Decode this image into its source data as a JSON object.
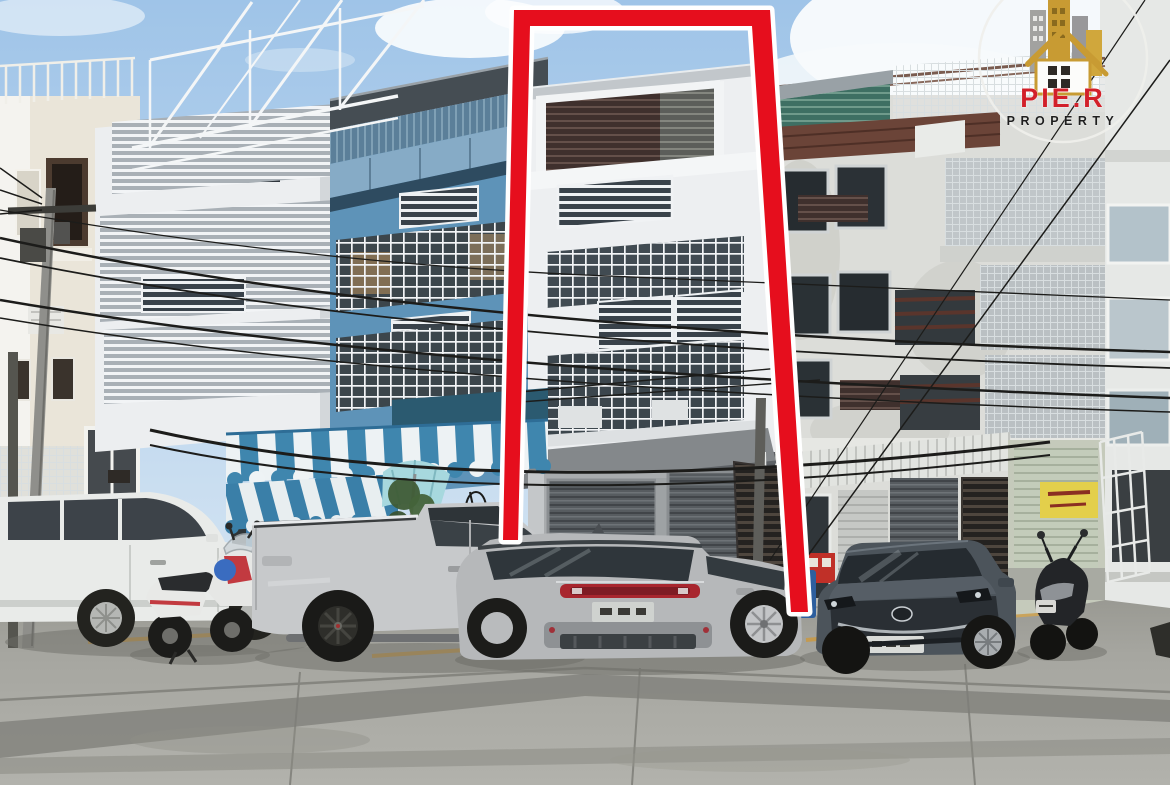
{
  "page": {
    "type": "real-estate-listing-photo",
    "subject": "Street view of shophouse row with one tall unit outlined in red"
  },
  "logo": {
    "brand": "PIE.R",
    "tagline": "PROPERTY",
    "brand_color": "#d2202a",
    "tagline_color": "#1e1e1e",
    "ring_color": "#efefec",
    "emblem_gold": "#c89b33",
    "emblem_gray": "#a0a0a0"
  },
  "highlight_frame": {
    "shape": "tall-rectangle-outline-open-bottom",
    "fill": "#e60e1d",
    "outline": "#ffffff",
    "meaning": "marks the subject building"
  },
  "palette": {
    "sky_top": "#9fc4e8",
    "sky_bottom": "#d7e6f3",
    "cloud": "#fbfdfe",
    "road": "#a6a6a2",
    "road_patch": "#7d7d78",
    "parking_line": "#c49a4f",
    "awning_blue": "#3f86ae",
    "awning_white": "#edf2f4",
    "subject_facade": "#edeff1",
    "subject_top_louver": "#3f302d",
    "blue_building": "#5e93b8",
    "white_louver_building": "#eceef0",
    "cream_building": "#eae5d9",
    "right_building": "#dcddd9",
    "teal_louver": "#3e6f63",
    "rust_rail": "#6b4438",
    "shutter_gray": "#575c60",
    "sign_yellow": "#e3cf4b"
  },
  "scene": {
    "buildings": [
      {
        "name": "left-cream-walkup"
      },
      {
        "name": "white-louver-shophouse"
      },
      {
        "name": "blue-glass-shophouse"
      },
      {
        "name": "subject-shophouse-highlighted"
      },
      {
        "name": "aged-white-shophouse"
      },
      {
        "name": "far-right-building"
      }
    ],
    "vehicles": [
      {
        "name": "white-sedan"
      },
      {
        "name": "red-white-scooter"
      },
      {
        "name": "silver-pickup-truck"
      },
      {
        "name": "silver-suv"
      },
      {
        "name": "dark-gray-crossover"
      },
      {
        "name": "black-scooter"
      }
    ],
    "street_objects": [
      {
        "name": "blue-white-striped-awning"
      },
      {
        "name": "street-stall"
      },
      {
        "name": "cyan-umbrella"
      },
      {
        "name": "utility-poles"
      },
      {
        "name": "power-lines"
      },
      {
        "name": "red-vending-cabinets"
      },
      {
        "name": "blue-bin"
      }
    ]
  }
}
